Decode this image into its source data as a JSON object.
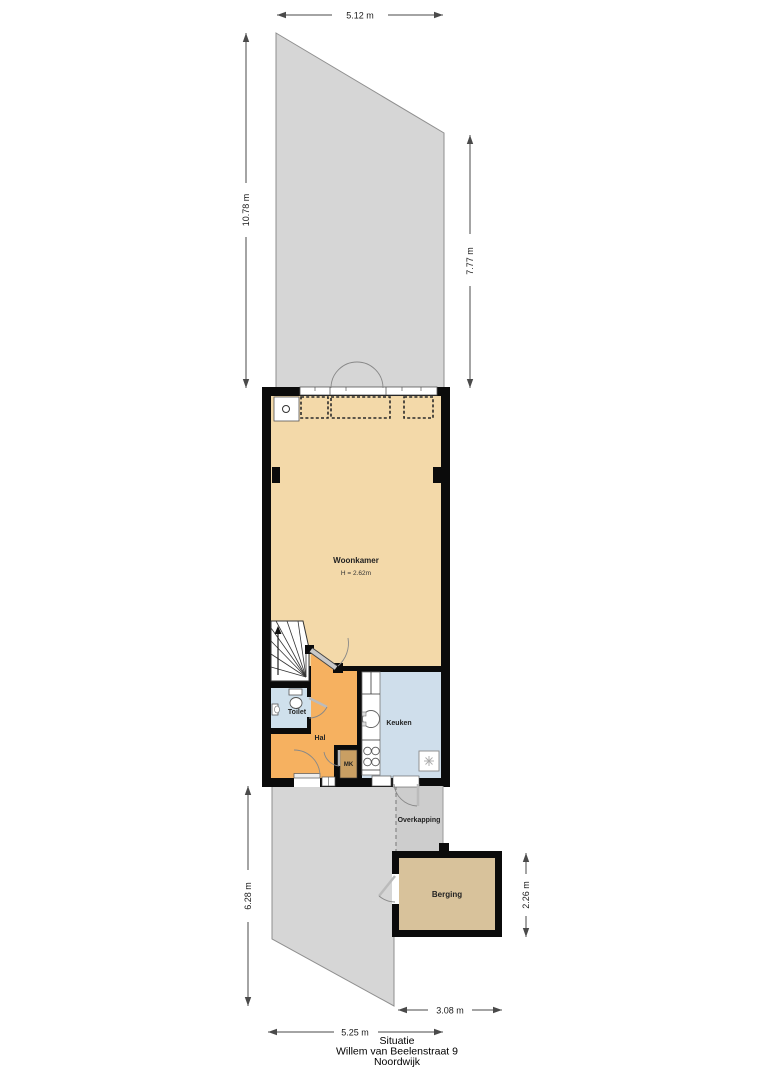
{
  "title": {
    "line1": "Situatie",
    "line2": "Willem van Beelenstraat 9",
    "line3": "Noordwijk"
  },
  "dimensions": {
    "garden_top_width": "5.12 m",
    "garden_left_height": "10.78 m",
    "garden_right_height": "7.77 m",
    "lower_garden_height": "6.28 m",
    "berging_depth": "2.26 m",
    "berging_width": "3.08 m",
    "lower_garden_width": "5.25 m"
  },
  "rooms": {
    "woonkamer": {
      "label": "Woonkamer",
      "ceiling_height": "H = 2.62m"
    },
    "toilet": {
      "label": "Toilet"
    },
    "hal": {
      "label": "Hal"
    },
    "keuken": {
      "label": "Keuken"
    },
    "meterkast": {
      "label": "MK"
    },
    "overkapping": {
      "label": "Overkapping"
    },
    "berging": {
      "label": "Berging"
    }
  },
  "icons": {
    "stairs": "winder-stairs-with-up-arrow",
    "door": "quarter-circle-door-swing",
    "toilet": "toilet-bowl-and-tank",
    "sink": "round-kitchen-sink",
    "stove": "four-burner-stove",
    "appliance": "appliance-square-symbol"
  },
  "colors": {
    "garden": "#d6d6d6",
    "overkapping": "#cdcdcd",
    "woonkamer": "#f3d9a9",
    "hal": "#f6b160",
    "toilet": "#cfe0ec",
    "keuken": "#cfdeeb",
    "berging": "#d8c29b",
    "meterkast": "#c99f63",
    "wall": "#0b0b0b"
  }
}
